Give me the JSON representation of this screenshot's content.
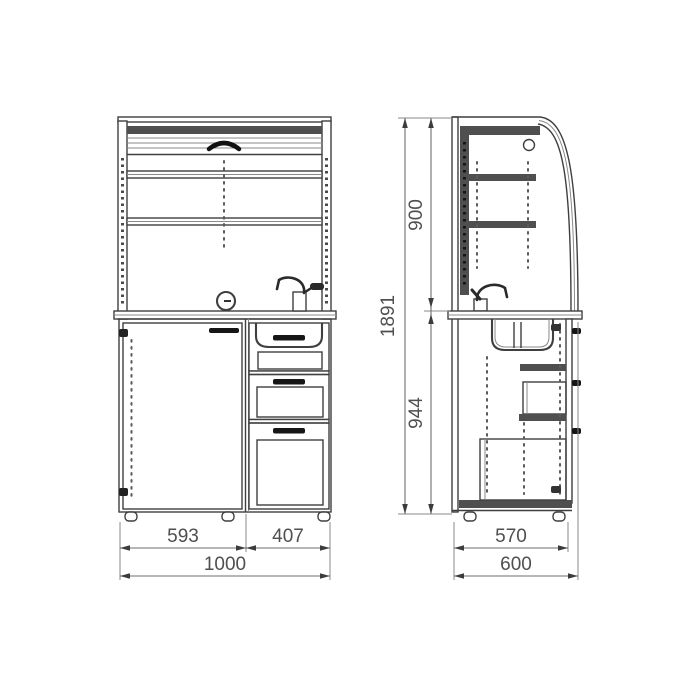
{
  "drawing": {
    "type": "furniture-dimension-drawing",
    "views": {
      "front": {
        "name": "front-view"
      },
      "side": {
        "name": "side-view"
      }
    },
    "dimensions": {
      "front_left_width": "593",
      "front_right_width": "407",
      "front_total_width": "1000",
      "side_depth": "570",
      "side_total_depth": "600",
      "upper_section_height": "900",
      "lower_section_height": "944",
      "total_height": "1891"
    },
    "colors": {
      "line": "#3f3f3f",
      "dark_fill": "#4f4f4f",
      "handle": "#161616",
      "dimension_text": "#4f4f4f",
      "background": "#ffffff"
    }
  }
}
